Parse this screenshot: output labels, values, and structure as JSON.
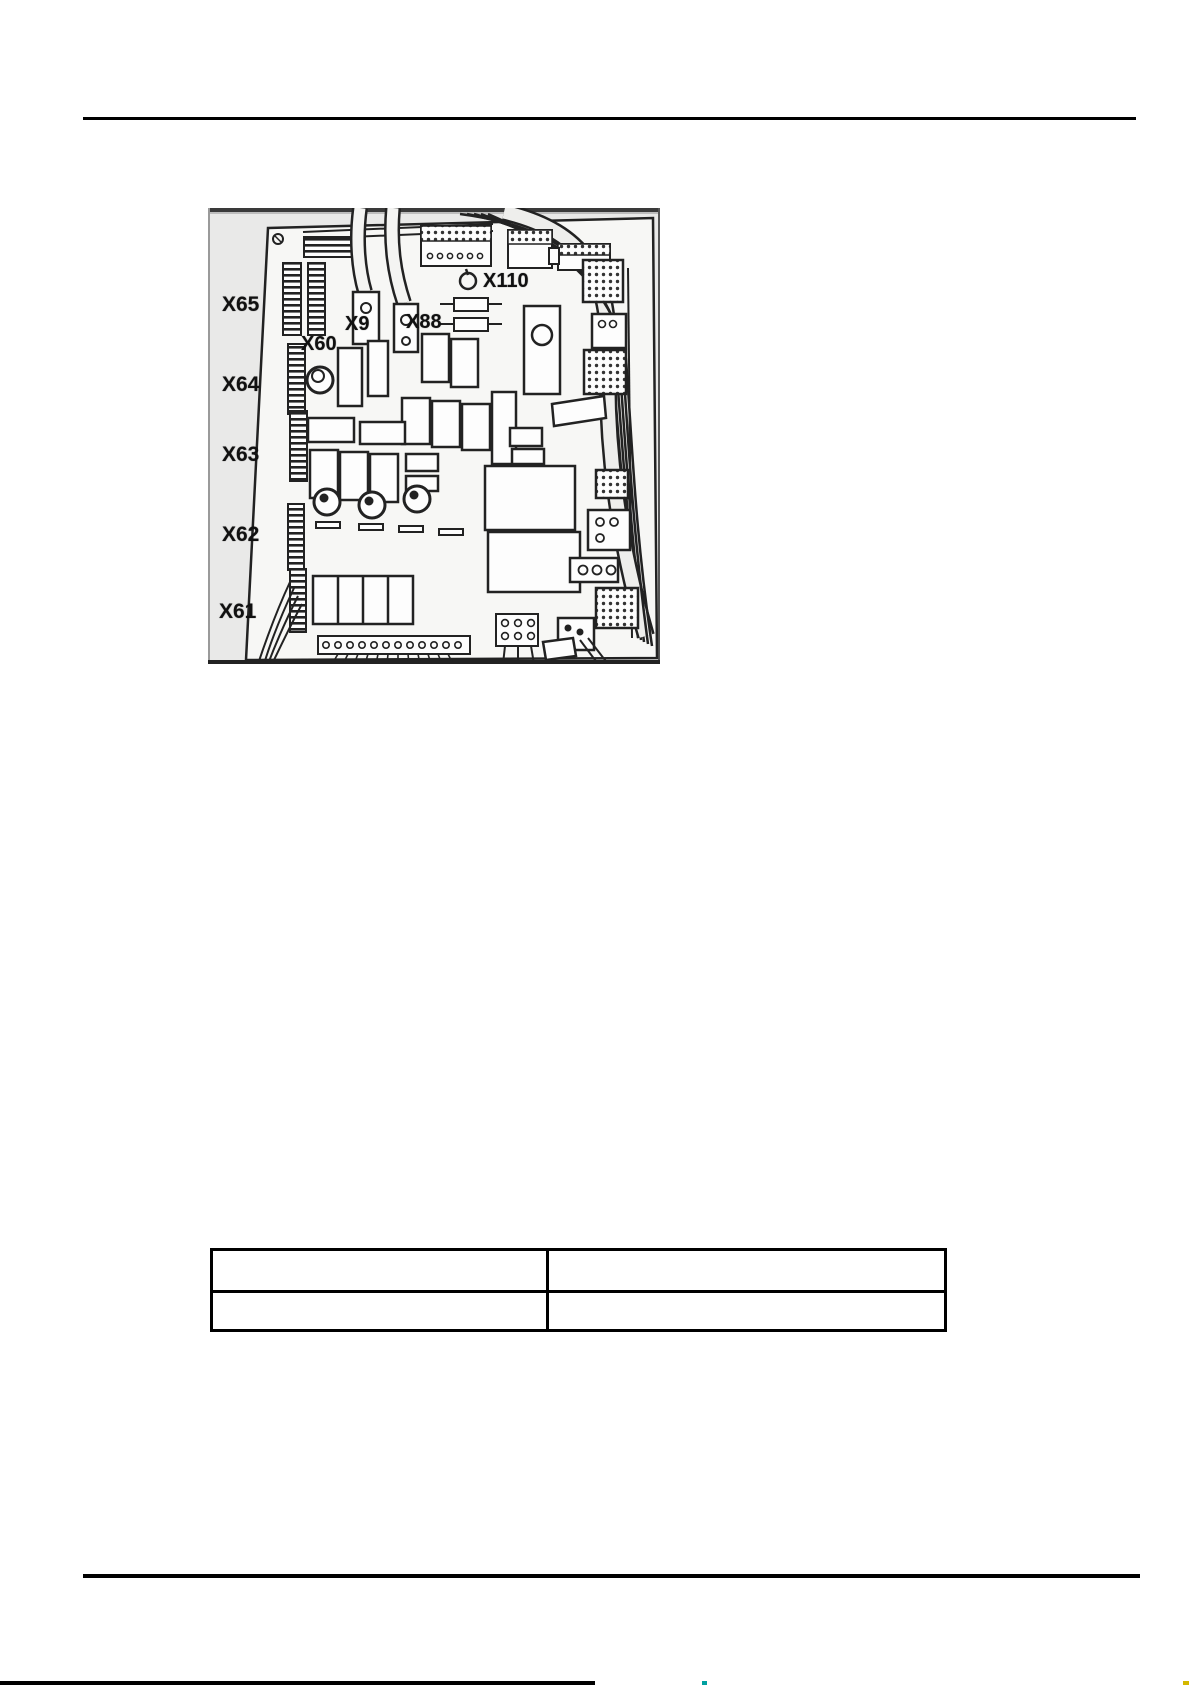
{
  "figure": {
    "labels": {
      "x65": "X65",
      "x64": "X64",
      "x63": "X63",
      "x62": "X62",
      "x61": "X61",
      "x60": "X60",
      "x9": "X9",
      "x88": "X88",
      "x110": "X110"
    },
    "icons": {
      "x110_marker": "screw-icon"
    }
  },
  "table": {
    "rows": [
      {
        "cells": [
          "",
          ""
        ]
      },
      {
        "cells": [
          "",
          ""
        ]
      }
    ]
  },
  "colors": {
    "ink": "#1a1a1a",
    "figure_background": "#e9e9e8",
    "board_background": "#f7f7f5",
    "edge_fleck_teal": "#00a0a0",
    "edge_fleck_yellow": "#d4b800"
  }
}
